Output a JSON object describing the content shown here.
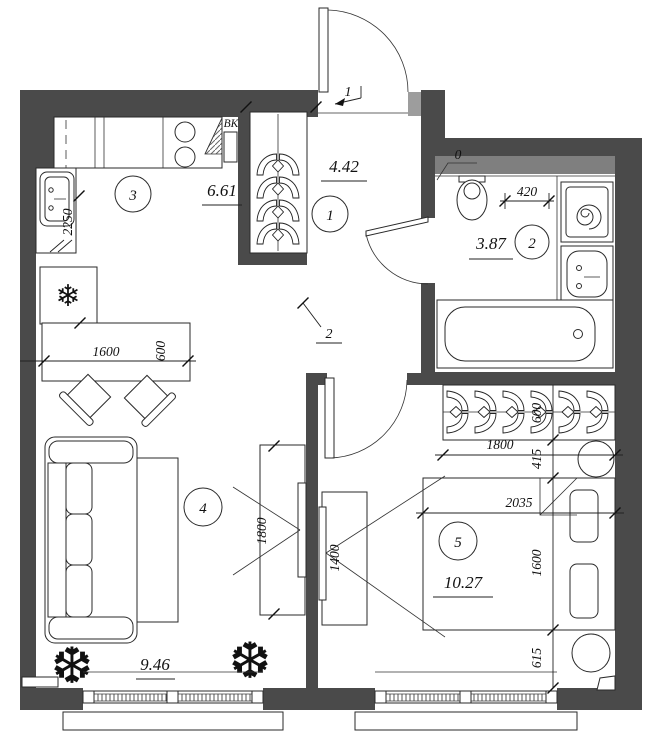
{
  "plan": {
    "rooms": [
      {
        "id": "hallway",
        "number": "1",
        "area": "4.42"
      },
      {
        "id": "bathroom",
        "number": "2",
        "area": "3.87"
      },
      {
        "id": "kitchen",
        "number": "3",
        "area": "6.61"
      },
      {
        "id": "living",
        "number": "4",
        "area": "9.46"
      },
      {
        "id": "bedroom",
        "number": "5",
        "area": "10.27"
      }
    ],
    "doors": [
      {
        "mark": "1"
      },
      {
        "mark": "2"
      }
    ],
    "annotations": {
      "vent_duct": "ВК",
      "threshold": "0"
    },
    "dimensions": {
      "kitchen_counter_len": "2250",
      "table_len": "1600",
      "table_depth": "600",
      "living_tv_len": "1800",
      "bedroom_tv_len": "1400",
      "bath_gap": "420",
      "wardrobe_len": "1800",
      "wardrobe_depth": "600",
      "gap_wardrobe_bed": "415",
      "bed_width": "2035",
      "bed_length": "1600",
      "gap_bed_window": "615"
    },
    "icons": {
      "fridge_snowflake": "❄",
      "plant": "❆"
    },
    "colors": {
      "wall": "#4a4a4a",
      "shaft": "#7f7f7f",
      "jamb": "#9d9d9d"
    }
  }
}
